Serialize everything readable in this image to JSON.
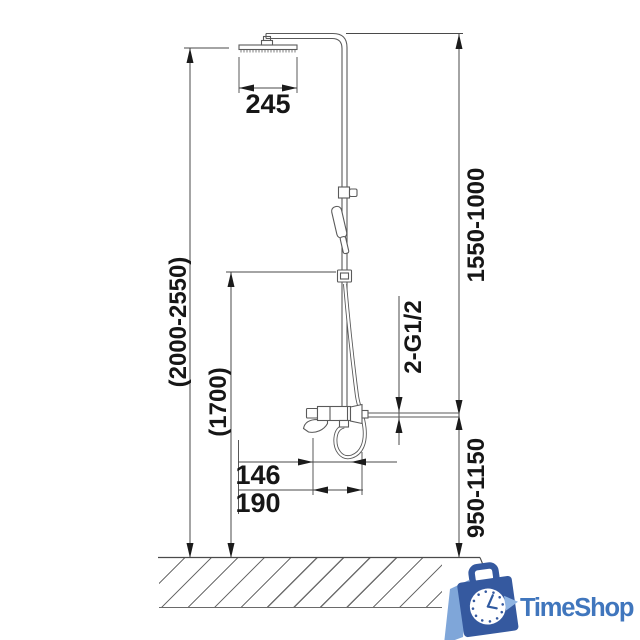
{
  "drawing": {
    "type": "technical-dimension-drawing",
    "subject": "shower column with rain head, hand shower and wall mixer",
    "line_color": "#5a5a5a",
    "dimension_color": "#161616",
    "labels": {
      "head_width": "245",
      "overall_height_range": "(2000-2550)",
      "hand_shower_holder_height": "(1700)",
      "upper_riser_range": "1550-1000",
      "wall_connection_thread": "2-G1/2",
      "mixer_height_range": "950-1150",
      "offset_small": "146",
      "offset_large": "190"
    }
  },
  "branding": {
    "logo_text": "TimeShop",
    "logo_text_color": "#4076bd",
    "icon": "shopping-bag-clock-icon",
    "icon_colors": {
      "bag": "#35599f",
      "accent": "#7fa6d9",
      "clock_face": "#ffffff"
    }
  }
}
